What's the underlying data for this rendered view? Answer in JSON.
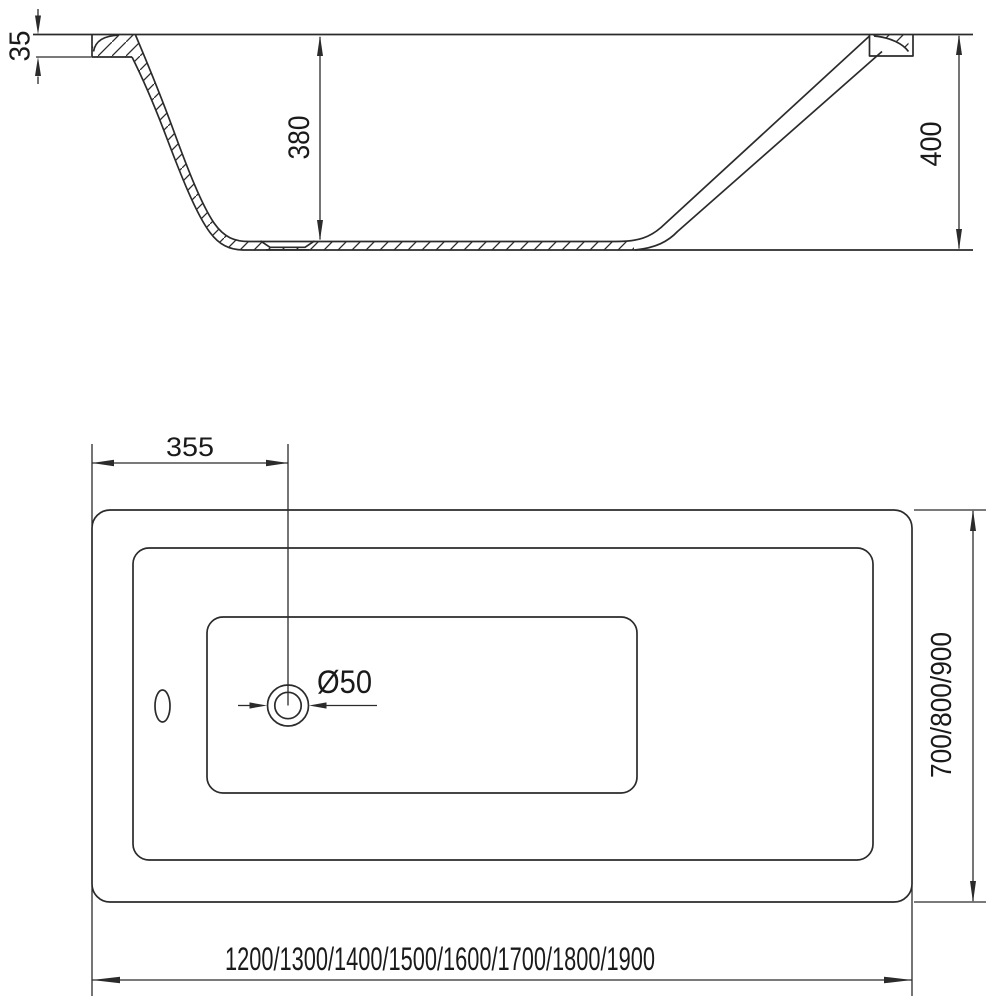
{
  "drawing": {
    "type": "bathtub technical drawing",
    "stroke_color": "#2b2b2b",
    "text_color": "#1a1a1a",
    "background_color": "#ffffff",
    "side_section": {
      "rim_height_label": "35",
      "depth_label": "380",
      "height_label": "400"
    },
    "plan_view": {
      "drain_offset_label": "355",
      "drain_diameter_label": "Ø50",
      "width_options_label": "700/800/900",
      "length_options_label": "1200/1300/1400/1500/1600/1700/1800/1900"
    }
  }
}
